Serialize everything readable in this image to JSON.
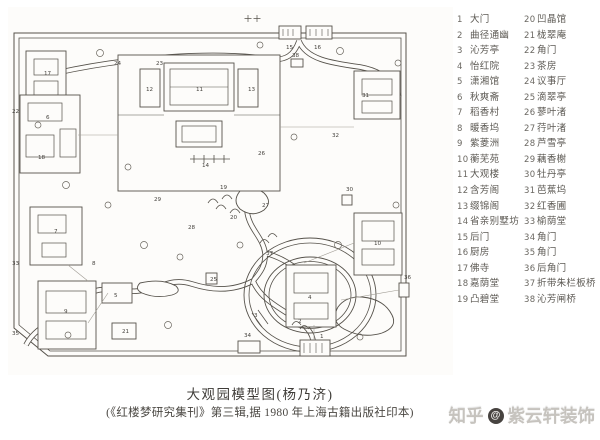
{
  "caption": {
    "title": "大观园模型图(杨乃济)",
    "source": "(《红楼梦研究集刊》第三辑,据 1980 年上海古籍出版社印本)"
  },
  "watermark": {
    "brand": "知乎",
    "at": "@",
    "handle": "紫云轩装饰"
  },
  "legend": {
    "col1": [
      {
        "no": "1",
        "name": "大门"
      },
      {
        "no": "2",
        "name": "曲径通幽"
      },
      {
        "no": "3",
        "name": "沁芳亭"
      },
      {
        "no": "4",
        "name": "怡红院"
      },
      {
        "no": "5",
        "name": "潇湘馆"
      },
      {
        "no": "6",
        "name": "秋爽斋"
      },
      {
        "no": "7",
        "name": "稻香村"
      },
      {
        "no": "8",
        "name": "暖香坞"
      },
      {
        "no": "9",
        "name": "紫菱洲"
      },
      {
        "no": "10",
        "name": "蘅芜苑"
      },
      {
        "no": "11",
        "name": "大观楼"
      },
      {
        "no": "12",
        "name": "含芳阁"
      },
      {
        "no": "13",
        "name": "缀锦阁"
      },
      {
        "no": "14",
        "name": "省亲别墅坊"
      },
      {
        "no": "15",
        "name": "后门"
      },
      {
        "no": "16",
        "name": "厨房"
      },
      {
        "no": "17",
        "name": "佛寺"
      },
      {
        "no": "18",
        "name": "嘉荫堂"
      },
      {
        "no": "19",
        "name": "凸碧堂"
      }
    ],
    "col2": [
      {
        "no": "20",
        "name": "凹晶馆"
      },
      {
        "no": "21",
        "name": "栊翠庵"
      },
      {
        "no": "22",
        "name": "角门"
      },
      {
        "no": "23",
        "name": "茶房"
      },
      {
        "no": "24",
        "name": "议事厅"
      },
      {
        "no": "25",
        "name": "滴翠亭"
      },
      {
        "no": "26",
        "name": "蓼叶渚"
      },
      {
        "no": "27",
        "name": "荇叶渚"
      },
      {
        "no": "28",
        "name": "芦雪亭"
      },
      {
        "no": "29",
        "name": "藕香榭"
      },
      {
        "no": "30",
        "name": "牡丹亭"
      },
      {
        "no": "31",
        "name": "芭蕉坞"
      },
      {
        "no": "32",
        "name": "红香圃"
      },
      {
        "no": "33",
        "name": "榆荫堂"
      },
      {
        "no": "34",
        "name": "角门"
      },
      {
        "no": "35",
        "name": "角门"
      },
      {
        "no": "36",
        "name": "后角门"
      },
      {
        "no": "37",
        "name": "折带朱栏板桥"
      },
      {
        "no": "38",
        "name": "沁芳闸桥"
      }
    ]
  },
  "map": {
    "ink_color": "#56524b",
    "paper_color": "#fdfcfa",
    "labels": [
      {
        "n": "1",
        "x": 312,
        "y": 331
      },
      {
        "n": "2",
        "x": 290,
        "y": 316
      },
      {
        "n": "3",
        "x": 246,
        "y": 310
      },
      {
        "n": "4",
        "x": 300,
        "y": 292
      },
      {
        "n": "5",
        "x": 106,
        "y": 290
      },
      {
        "n": "6",
        "x": 38,
        "y": 112
      },
      {
        "n": "7",
        "x": 46,
        "y": 226
      },
      {
        "n": "8",
        "x": 84,
        "y": 258
      },
      {
        "n": "9",
        "x": 56,
        "y": 306
      },
      {
        "n": "10",
        "x": 366,
        "y": 238
      },
      {
        "n": "11",
        "x": 188,
        "y": 84
      },
      {
        "n": "12",
        "x": 138,
        "y": 84
      },
      {
        "n": "13",
        "x": 240,
        "y": 84
      },
      {
        "n": "14",
        "x": 194,
        "y": 160
      },
      {
        "n": "15",
        "x": 278,
        "y": 42
      },
      {
        "n": "16",
        "x": 306,
        "y": 42
      },
      {
        "n": "17",
        "x": 36,
        "y": 68
      },
      {
        "n": "18",
        "x": 30,
        "y": 152
      },
      {
        "n": "19",
        "x": 212,
        "y": 182
      },
      {
        "n": "20",
        "x": 222,
        "y": 212
      },
      {
        "n": "21",
        "x": 114,
        "y": 326
      },
      {
        "n": "22",
        "x": 4,
        "y": 106
      },
      {
        "n": "23",
        "x": 148,
        "y": 58
      },
      {
        "n": "24",
        "x": 106,
        "y": 58
      },
      {
        "n": "25",
        "x": 202,
        "y": 274
      },
      {
        "n": "26",
        "x": 250,
        "y": 148
      },
      {
        "n": "27",
        "x": 254,
        "y": 200
      },
      {
        "n": "28",
        "x": 180,
        "y": 222
      },
      {
        "n": "29",
        "x": 146,
        "y": 194
      },
      {
        "n": "30",
        "x": 338,
        "y": 184
      },
      {
        "n": "31",
        "x": 354,
        "y": 90
      },
      {
        "n": "32",
        "x": 324,
        "y": 130
      },
      {
        "n": "33",
        "x": 4,
        "y": 258
      },
      {
        "n": "34",
        "x": 236,
        "y": 330
      },
      {
        "n": "35",
        "x": 4,
        "y": 328
      },
      {
        "n": "36",
        "x": 396,
        "y": 272
      },
      {
        "n": "37",
        "x": 258,
        "y": 248
      },
      {
        "n": "38",
        "x": 284,
        "y": 50
      }
    ]
  }
}
